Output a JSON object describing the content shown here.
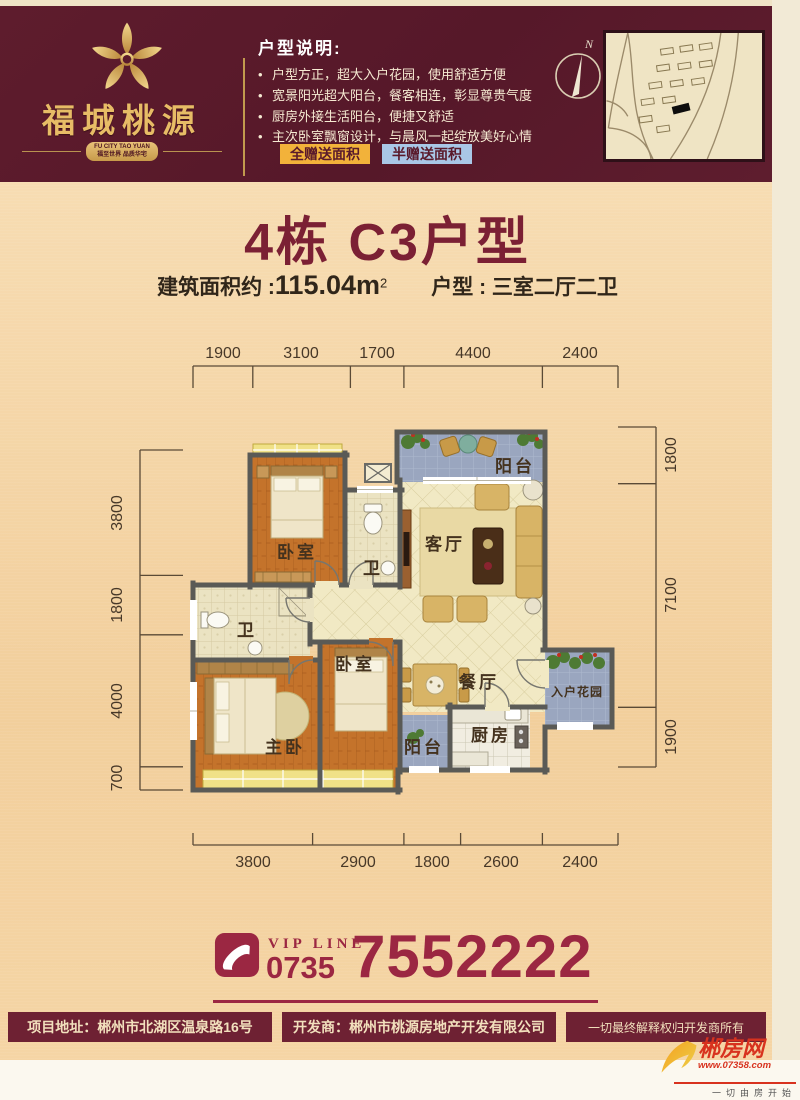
{
  "colors": {
    "header_bg": "#5a1a2b",
    "title_maroon": "#7b2034",
    "crimson": "#9b2742",
    "gold": "#e7bc66",
    "badge_full_bg": "#f2b23a",
    "badge_half_bg": "#a9c7e6",
    "page_peach": "#f5d5a5"
  },
  "brand": {
    "name": "福城桃源",
    "tagline_en": "FU CITY TAO YUAN",
    "tagline_cn": "福至世界 品质华宅"
  },
  "header": {
    "spec_title": "户型说明:",
    "spec_bullets": [
      "户型方正，超大入户花园，使用舒适方便",
      "宽景阳光超大阳台，餐客相连，彰显尊贵气度",
      "厨房外接生活阳台，便捷又舒适",
      "主次卧室飘窗设计，与晨风一起绽放美好心情"
    ],
    "badge_full": "全赠送面积",
    "badge_half": "半赠送面积",
    "compass_north": "N"
  },
  "unit": {
    "title": "4栋 C3户型",
    "area_label": "建筑面积约 :",
    "area_value": "115.04m",
    "area_sup": "2",
    "layout_label": "户型 : 三室二厅二卫"
  },
  "floorplan": {
    "rooms": {
      "bedroom_top": "卧室",
      "bath_top": "卫",
      "living": "客厅",
      "balcony_top": "阳台",
      "bath_left": "卫",
      "bedroom_mid": "卧室",
      "dining": "餐厅",
      "entry_garden": "入户花园",
      "master": "主卧",
      "balcony_bottom": "阳台",
      "kitchen": "厨房"
    },
    "dims": {
      "top": [
        "1900",
        "3100",
        "1700",
        "4400",
        "2400"
      ],
      "bottom": [
        "3800",
        "2900",
        "1800",
        "2600",
        "2400"
      ],
      "left": [
        "3800",
        "1800",
        "4000",
        "700"
      ],
      "right": [
        "1800",
        "7100",
        "1900"
      ]
    }
  },
  "contact": {
    "vip_label": "VIP LINE",
    "area_code": "0735",
    "phone": "7552222"
  },
  "footer": {
    "address": "项目地址：郴州市北湖区温泉路16号",
    "developer": "开发商：郴州市桃源房地产开发有限公司",
    "rights": "一切最终解释权归开发商所有"
  },
  "watermark": {
    "site": "郴房网",
    "url": "www.07358.com",
    "slogan": "一切由房开始"
  }
}
